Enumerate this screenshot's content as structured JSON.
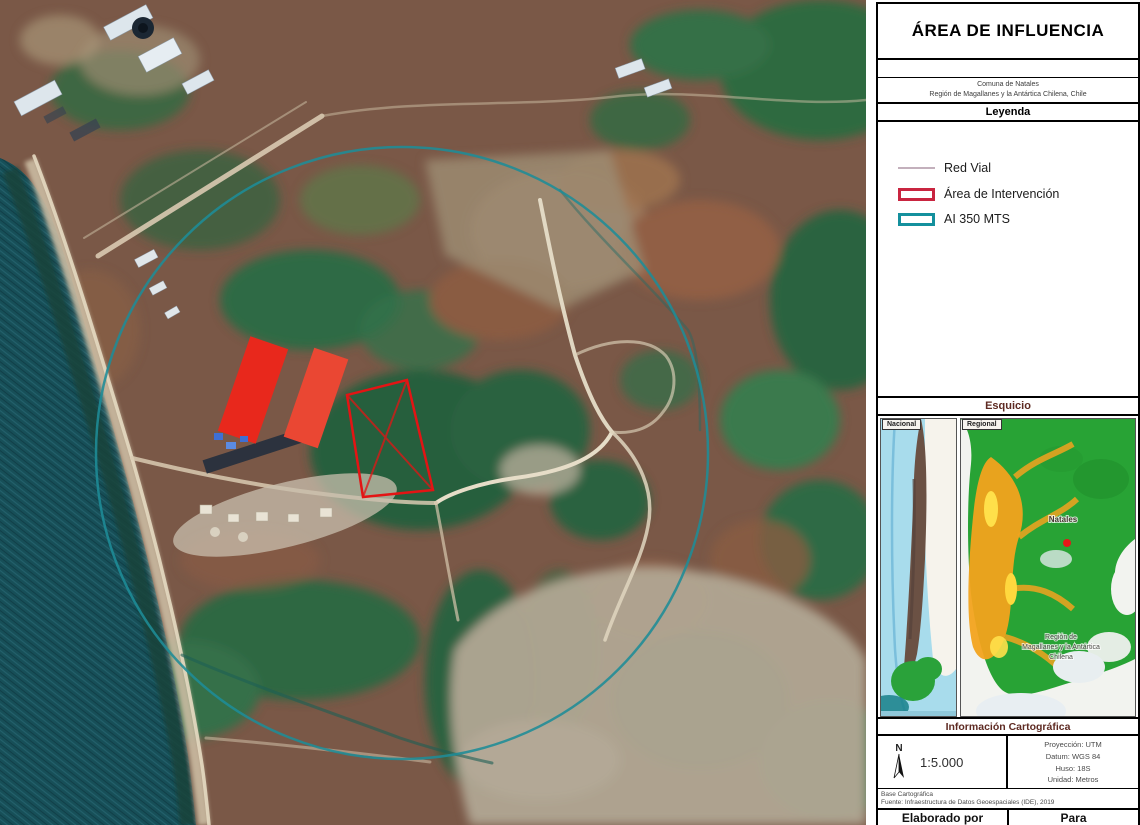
{
  "panel": {
    "title": "ÁREA DE INFLUENCIA",
    "subtitle": {
      "line1": "Comuna de Natales",
      "line2": "Región de Magallanes y la Antártica Chilena, Chile"
    },
    "legend": {
      "header": "Leyenda",
      "items": [
        {
          "label": "Red Vial",
          "swatch": "line",
          "color": "#c3b0bc"
        },
        {
          "label": "Área de Intervención",
          "swatch": "rect",
          "color": "#c92540"
        },
        {
          "label": "AI 350 MTS",
          "swatch": "rect",
          "color": "#14909d"
        }
      ]
    },
    "esquicio": {
      "header": "Esquicio",
      "national_tab": "Nacional",
      "regional_tab": "Regional",
      "regional_city_label": "Natales",
      "regional_region_label_line1": "Región de",
      "regional_region_label_line2": "Magallanes y la Antártica",
      "regional_region_label_line3": "Chilena"
    },
    "info": {
      "header": "Información Cartográfica",
      "north": "N",
      "scale": "1:5.000",
      "projection": "Proyección: UTM",
      "datum": "Datum: WGS 84",
      "zone": "Huso: 18S",
      "unit": "Unidad: Metros",
      "source_line1": "Base Cartográfica",
      "source_line2": "Fuente: Infraestructura de Datos Geoespaciales (IDE), 2019"
    },
    "footer": {
      "left": "Elaborado por",
      "right": "Para"
    }
  },
  "map": {
    "colors": {
      "buffer_circle": "#1e8c97",
      "intervention_outline": "#e31414",
      "ocean": "#174f58",
      "red_roof": "#e8281c"
    }
  }
}
